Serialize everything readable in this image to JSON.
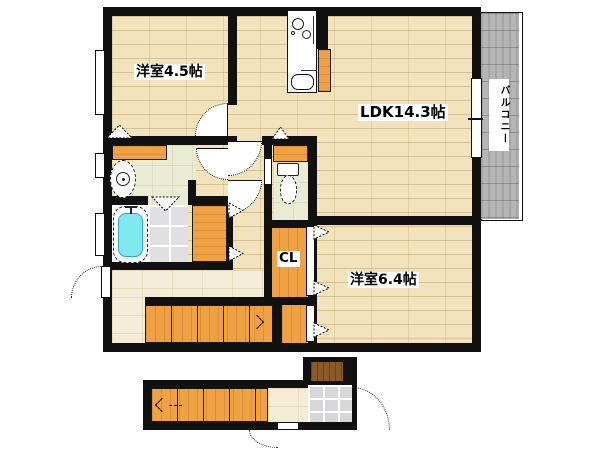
{
  "title": "2F floor plan",
  "rooms": {
    "western45": {
      "label": "洋室4.5帖"
    },
    "ldk": {
      "label": "LDK14.3帖"
    },
    "western64": {
      "label": "洋室6.4帖"
    },
    "closet": {
      "label": "CL"
    },
    "balcony": {
      "label": "バルコニー"
    }
  },
  "fixtures": [
    "kitchen-counter",
    "kitchen-sink",
    "stove-burners",
    "refrigerator-space",
    "washbasin",
    "bathtub",
    "bath-tile-floor",
    "toilet",
    "upper-staircase",
    "lower-staircase",
    "entrance-door",
    "genkan-tile",
    "door-swing-arcs",
    "window-symbols",
    "folding-door-triangles"
  ],
  "colors": {
    "wall": "#111111",
    "wood_floor": "#f3e3bd",
    "hall_floor": "#f4ecd6",
    "wet_floor_green": "#e9ebd3",
    "cabinet_orange": "#f0a144",
    "bathtub_cyan": "#7fe9ef",
    "tile_gray": "#e0e0e3",
    "balcony_gray": "#b5b5b5",
    "entrance_door_brown": "#8a5a28"
  }
}
